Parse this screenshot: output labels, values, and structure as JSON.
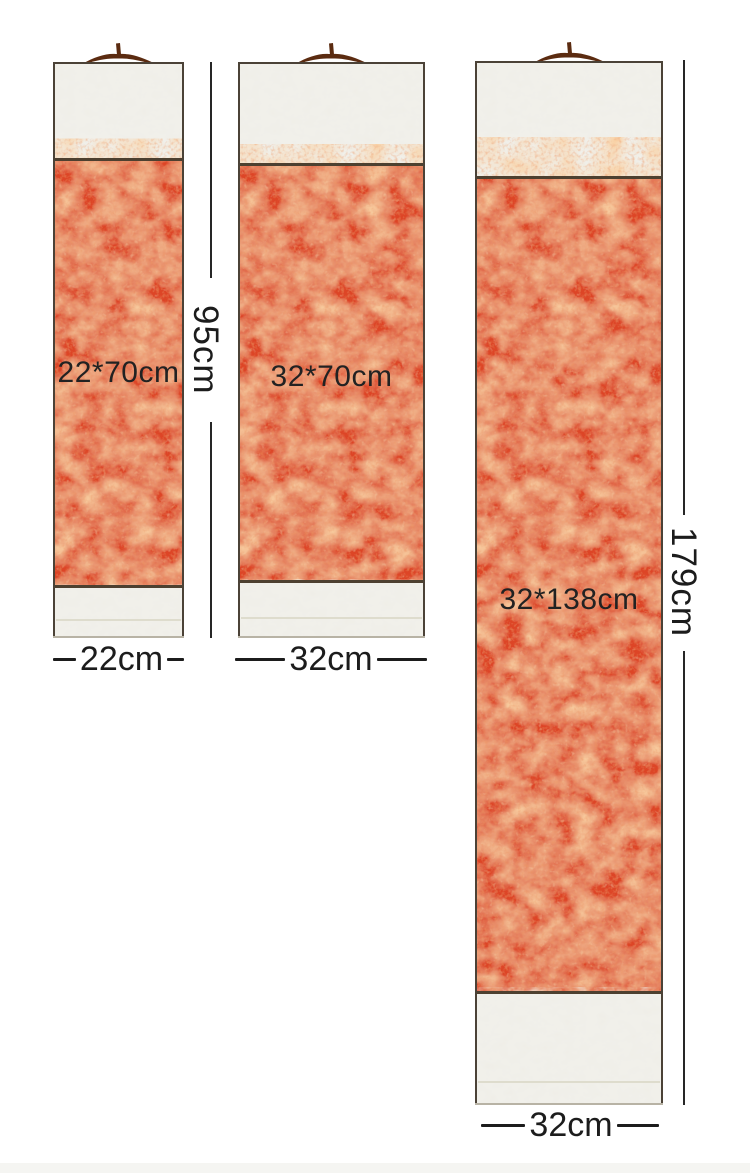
{
  "diagram": {
    "kind": "hanging-scroll size chart",
    "scrolls": [
      {
        "name": "scroll-small",
        "size_label": "22*70cm",
        "width_label": "22cm"
      },
      {
        "name": "scroll-medium",
        "size_label": "32*70cm",
        "width_label": "32cm"
      },
      {
        "name": "scroll-large",
        "size_label": "32*138cm",
        "width_label": "32cm"
      }
    ],
    "height_dimensions": [
      {
        "name": "height-left-pair",
        "label": "95cm"
      },
      {
        "name": "height-large",
        "label": "179cm"
      }
    ]
  },
  "icons": {
    "hanger": "scroll-hanger-hook-icon"
  },
  "colors": {
    "paper-red": "#dd4526",
    "paper-highlight": "#f2a15c",
    "mount-cream": "#f1f0ea",
    "frame-dark": "#4b4237",
    "hanger-brown": "#5b2b10",
    "annotation-text": "#1f1f1f",
    "bottom-strip": "#f5f5f2"
  }
}
